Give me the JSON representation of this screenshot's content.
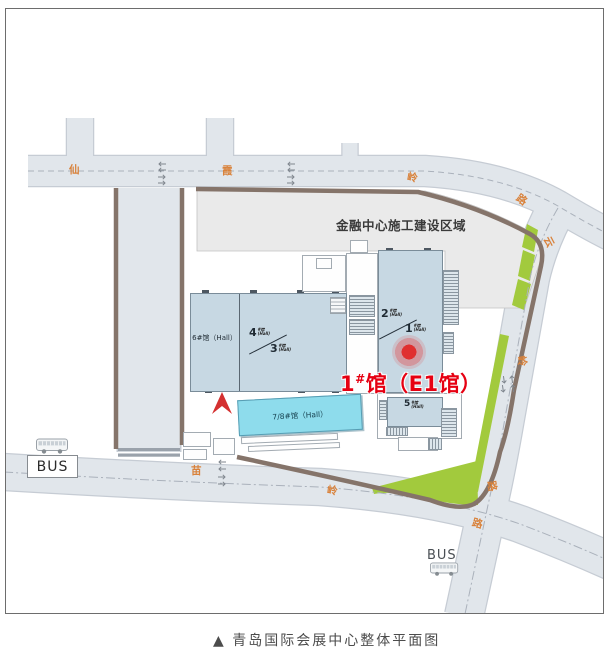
{
  "title": {
    "caption": "▲ 青岛国际会展中心整体平面图"
  },
  "construction_area": {
    "label": "金融中心施工建设区域"
  },
  "halls": {
    "hall6": {
      "label": "6#馆（Hall）"
    },
    "hall4": {
      "num": "4",
      "suffix": "#馆",
      "sub": "(Hall)"
    },
    "hall3": {
      "num": "3",
      "suffix": "#馆",
      "sub": "(Hall)"
    },
    "hall2": {
      "num": "2",
      "suffix": "#馆",
      "sub": "(Hall)"
    },
    "hall1": {
      "num": "1",
      "suffix": "#馆",
      "sub": "(Hall)"
    },
    "hall5": {
      "num": "5",
      "suffix": "#馆",
      "sub": "(Hall)"
    },
    "hall78": {
      "label": "7/8#馆（Hall）"
    }
  },
  "highlight": {
    "num": "1",
    "hash": "#",
    "rest": "馆（E1馆）"
  },
  "roads": {
    "xianxialing": {
      "chars": [
        "仙",
        "霞",
        "岭",
        "路"
      ]
    },
    "yunling": {
      "chars": [
        "云",
        "岭",
        "路"
      ]
    },
    "miaoling": {
      "chars": [
        "苗",
        "岭",
        "路"
      ]
    }
  },
  "bus_stops": {
    "west": "BUS",
    "south": "BUS"
  },
  "icons": {
    "bus": "bus-icon",
    "location_arrow": "red-nav-arrow-icon",
    "target": "red-target-dot-icon",
    "traffic_arrows": "lane-direction-arrow-icon"
  },
  "colors": {
    "road_fill": "#e1e6eb",
    "road_edge": "#c6ccd4",
    "boundary_brown": "#85746a",
    "green_strip": "#a2ca3d",
    "construction_gray": "#eaeaea",
    "hall_blue": "#c7d8e3",
    "hall_cyan": "#8edcec",
    "highlight_red": "#e60012",
    "road_label_orange": "#d9823b"
  }
}
